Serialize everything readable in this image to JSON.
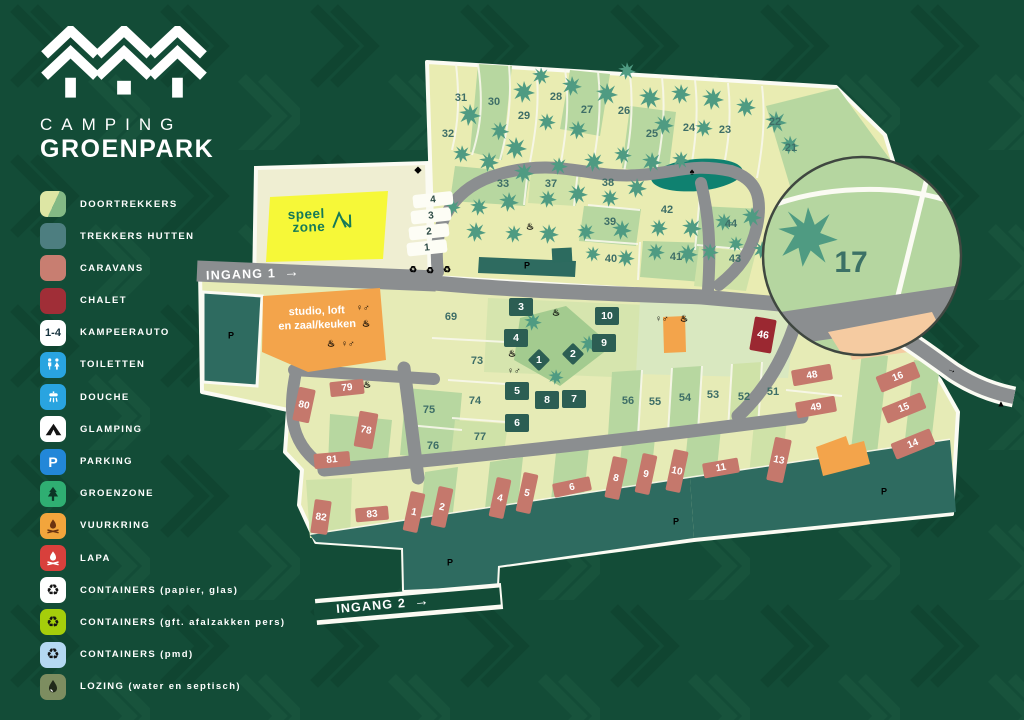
{
  "brand": {
    "name_line1": "CAMPING",
    "name_line2": "GROENPARK"
  },
  "legend": [
    {
      "id": "doortrekkers",
      "label": "DOORTREKKERS"
    },
    {
      "id": "trekkers-hutten",
      "label": "TREKKERS HUTTEN"
    },
    {
      "id": "caravans",
      "label": "CARAVANS"
    },
    {
      "id": "chalet",
      "label": "CHALET"
    },
    {
      "id": "kampeerauto",
      "label": "KAMPEERAUTO",
      "badge": "1-4"
    },
    {
      "id": "toiletten",
      "label": "TOILETTEN"
    },
    {
      "id": "douche",
      "label": "DOUCHE"
    },
    {
      "id": "glamping",
      "label": "GLAMPING"
    },
    {
      "id": "parking",
      "label": "PARKING",
      "badge": "P"
    },
    {
      "id": "groenzone",
      "label": "GROENZONE"
    },
    {
      "id": "vuurkring",
      "label": "VUURKRING"
    },
    {
      "id": "lapa",
      "label": "LAPA"
    },
    {
      "id": "containers-papier",
      "label": "CONTAINERS (papier, glas)",
      "glyph": "♻"
    },
    {
      "id": "containers-gft",
      "label": "CONTAINERS (gft. afalzakken pers)",
      "glyph": "♻"
    },
    {
      "id": "containers-pmd",
      "label": "CONTAINERS (pmd)",
      "glyph": "♻"
    },
    {
      "id": "lozing",
      "label": "LOZING (water en septisch)"
    }
  ],
  "map": {
    "entrances": [
      {
        "label": "INGANG 1",
        "arrow": "→"
      },
      {
        "label": "INGANG 2",
        "arrow": "→"
      }
    ],
    "speelzone": {
      "line1": "speel",
      "line2": "zone"
    },
    "studio": {
      "line1": "studio, loft",
      "line2": "en zaal/keuken"
    },
    "magnifier": {
      "plot": "17"
    },
    "plots": [
      {
        "n": "31",
        "x": 461,
        "y": 98
      },
      {
        "n": "30",
        "x": 494,
        "y": 102
      },
      {
        "n": "32",
        "x": 448,
        "y": 134
      },
      {
        "n": "29",
        "x": 524,
        "y": 116
      },
      {
        "n": "28",
        "x": 556,
        "y": 97
      },
      {
        "n": "27",
        "x": 587,
        "y": 110
      },
      {
        "n": "26",
        "x": 624,
        "y": 111
      },
      {
        "n": "25",
        "x": 652,
        "y": 134
      },
      {
        "n": "24",
        "x": 689,
        "y": 128
      },
      {
        "n": "23",
        "x": 725,
        "y": 130
      },
      {
        "n": "22",
        "x": 775,
        "y": 122
      },
      {
        "n": "21",
        "x": 791,
        "y": 148
      },
      {
        "n": "33",
        "x": 503,
        "y": 184
      },
      {
        "n": "37",
        "x": 551,
        "y": 184
      },
      {
        "n": "38",
        "x": 608,
        "y": 183
      },
      {
        "n": "39",
        "x": 610,
        "y": 222
      },
      {
        "n": "40",
        "x": 611,
        "y": 259
      },
      {
        "n": "41",
        "x": 676,
        "y": 257
      },
      {
        "n": "42",
        "x": 667,
        "y": 210
      },
      {
        "n": "43",
        "x": 735,
        "y": 259
      },
      {
        "n": "44",
        "x": 731,
        "y": 224
      },
      {
        "n": "69",
        "x": 451,
        "y": 317
      },
      {
        "n": "73",
        "x": 477,
        "y": 361
      },
      {
        "n": "74",
        "x": 475,
        "y": 401
      },
      {
        "n": "75",
        "x": 429,
        "y": 410
      },
      {
        "n": "76",
        "x": 433,
        "y": 446
      },
      {
        "n": "77",
        "x": 480,
        "y": 437
      },
      {
        "n": "51",
        "x": 773,
        "y": 392
      },
      {
        "n": "52",
        "x": 744,
        "y": 397
      },
      {
        "n": "53",
        "x": 713,
        "y": 395
      },
      {
        "n": "54",
        "x": 685,
        "y": 398
      },
      {
        "n": "55",
        "x": 655,
        "y": 402
      },
      {
        "n": "56",
        "x": 628,
        "y": 401
      }
    ],
    "huts": [
      {
        "n": "3",
        "x": 521,
        "y": 307
      },
      {
        "n": "10",
        "x": 607,
        "y": 316
      },
      {
        "n": "4",
        "x": 516,
        "y": 338
      },
      {
        "n": "9",
        "x": 604,
        "y": 343
      },
      {
        "n": "1",
        "x": 539,
        "y": 360,
        "w": 16,
        "h": 16,
        "r": 45,
        "cls": "diamond"
      },
      {
        "n": "2",
        "x": 573,
        "y": 354,
        "w": 16,
        "h": 16,
        "r": 45,
        "cls": "diamond"
      },
      {
        "n": "5",
        "x": 517,
        "y": 391
      },
      {
        "n": "8",
        "x": 547,
        "y": 400
      },
      {
        "n": "7",
        "x": 574,
        "y": 399
      },
      {
        "n": "6",
        "x": 517,
        "y": 423
      }
    ],
    "caravans": [
      {
        "n": "79",
        "x": 347,
        "y": 388,
        "w": 34,
        "h": 15,
        "r": -6
      },
      {
        "n": "80",
        "x": 304,
        "y": 405,
        "w": 17,
        "h": 34,
        "r": 12
      },
      {
        "n": "78",
        "x": 366,
        "y": 430,
        "w": 19,
        "h": 36,
        "r": 10
      },
      {
        "n": "81",
        "x": 332,
        "y": 460,
        "w": 36,
        "h": 15,
        "r": -5
      },
      {
        "n": "82",
        "x": 321,
        "y": 517,
        "w": 17,
        "h": 34,
        "r": 8
      },
      {
        "n": "83",
        "x": 372,
        "y": 514,
        "w": 33,
        "h": 14,
        "r": -5
      },
      {
        "n": "1",
        "x": 414,
        "y": 512,
        "w": 15,
        "h": 40,
        "r": 12
      },
      {
        "n": "2",
        "x": 442,
        "y": 507,
        "w": 15,
        "h": 40,
        "r": 12
      },
      {
        "n": "4",
        "x": 500,
        "y": 498,
        "w": 15,
        "h": 40,
        "r": 12
      },
      {
        "n": "5",
        "x": 527,
        "y": 493,
        "w": 15,
        "h": 40,
        "r": 12
      },
      {
        "n": "6",
        "x": 572,
        "y": 487,
        "w": 38,
        "h": 14,
        "r": -12
      },
      {
        "n": "8",
        "x": 616,
        "y": 478,
        "w": 15,
        "h": 42,
        "r": 12
      },
      {
        "n": "9",
        "x": 646,
        "y": 474,
        "w": 15,
        "h": 40,
        "r": 12
      },
      {
        "n": "10",
        "x": 677,
        "y": 471,
        "w": 15,
        "h": 42,
        "r": 12
      },
      {
        "n": "11",
        "x": 721,
        "y": 468,
        "w": 36,
        "h": 15,
        "r": -10
      },
      {
        "n": "13",
        "x": 779,
        "y": 460,
        "w": 17,
        "h": 44,
        "r": 12
      },
      {
        "n": "16",
        "x": 898,
        "y": 377,
        "w": 42,
        "h": 17,
        "r": -22
      },
      {
        "n": "15",
        "x": 904,
        "y": 408,
        "w": 42,
        "h": 17,
        "r": -22
      },
      {
        "n": "14",
        "x": 913,
        "y": 444,
        "w": 42,
        "h": 17,
        "r": -22
      },
      {
        "n": "48",
        "x": 812,
        "y": 375,
        "w": 40,
        "h": 16,
        "r": -10
      },
      {
        "n": "49",
        "x": 816,
        "y": 407,
        "w": 40,
        "h": 16,
        "r": -10
      }
    ],
    "chalets": [
      {
        "n": "46",
        "x": 763,
        "y": 335,
        "w": 22,
        "h": 34,
        "r": 10
      }
    ],
    "camper_spots": [
      {
        "n": "4",
        "x": 433,
        "y": 200,
        "w": 40,
        "h": 13,
        "r": -6
      },
      {
        "n": "3",
        "x": 431,
        "y": 216,
        "w": 40,
        "h": 13,
        "r": -6
      },
      {
        "n": "2",
        "x": 429,
        "y": 232,
        "w": 40,
        "h": 13,
        "r": -6
      },
      {
        "n": "1",
        "x": 427,
        "y": 248,
        "w": 40,
        "h": 13,
        "r": -6
      }
    ],
    "icons": [
      {
        "t": "parking",
        "name": "parking-icon",
        "g": "P",
        "x": 231,
        "y": 336
      },
      {
        "t": "parking",
        "name": "parking-icon",
        "g": "P",
        "x": 527,
        "y": 266
      },
      {
        "t": "parking",
        "name": "parking-icon",
        "g": "P",
        "x": 450,
        "y": 563
      },
      {
        "t": "parking",
        "name": "parking-icon",
        "g": "P",
        "x": 676,
        "y": 522
      },
      {
        "t": "parking",
        "name": "parking-icon",
        "g": "P",
        "x": 884,
        "y": 492
      },
      {
        "t": "toilet",
        "name": "toilets-icon",
        "g": "♀♂",
        "x": 363,
        "y": 308
      },
      {
        "t": "toilet",
        "name": "toilets-icon",
        "g": "♀♂",
        "x": 348,
        "y": 344
      },
      {
        "t": "toilet",
        "name": "toilets-icon",
        "g": "♀♂",
        "x": 514,
        "y": 371
      },
      {
        "t": "toilet",
        "name": "toilets-icon",
        "g": "♀♂",
        "x": 662,
        "y": 319
      },
      {
        "t": "shower",
        "name": "shower-icon",
        "g": "♨",
        "x": 366,
        "y": 324
      },
      {
        "t": "shower",
        "name": "shower-icon",
        "g": "♨",
        "x": 331,
        "y": 344
      },
      {
        "t": "shower",
        "name": "shower-icon",
        "g": "♨",
        "x": 512,
        "y": 354
      },
      {
        "t": "shower",
        "name": "shower-icon",
        "g": "♨",
        "x": 684,
        "y": 319
      },
      {
        "t": "shower",
        "name": "shower-icon",
        "g": "♨",
        "x": 367,
        "y": 385
      },
      {
        "t": "recpmd",
        "name": "recycle-pmd-icon",
        "g": "♻",
        "x": 413,
        "y": 270
      },
      {
        "t": "recpap",
        "name": "recycle-paper-icon",
        "g": "♻",
        "x": 430,
        "y": 271
      },
      {
        "t": "recgft",
        "name": "recycle-gft-icon",
        "g": "♻",
        "x": 447,
        "y": 270
      },
      {
        "t": "vuur",
        "name": "campfire-icon",
        "g": "♨",
        "x": 530,
        "y": 227
      },
      {
        "t": "lapa",
        "name": "lapa-icon",
        "g": "♨",
        "x": 556,
        "y": 313
      },
      {
        "t": "groenbox",
        "name": "tree-icon",
        "g": "♠",
        "x": 692,
        "y": 172
      },
      {
        "t": "glamping",
        "name": "glamping-icon",
        "g": "▲",
        "x": 1001,
        "y": 404
      },
      {
        "t": "lozing",
        "name": "drain-icon",
        "g": "◆",
        "x": 418,
        "y": 170
      },
      {
        "t": "arrow",
        "name": "exit-arrow-icon",
        "g": "→",
        "x": 952,
        "y": 370,
        "r": 20
      }
    ]
  },
  "palette": {
    "background": "#134c37",
    "plot_yellow": "#e9ecb2",
    "plot_green": "#b7d7a0",
    "road_gray": "#8b8e90",
    "water_teal": "#0f8170",
    "parking_teal": "#2e6b60",
    "caravan_salmon": "#c5786c",
    "chalet_red": "#9b2831",
    "hut_teal": "#2c5e53",
    "building_orange": "#f3a44b",
    "speelzone_yellow": "#f6f838",
    "accent_blue": "#2287d8"
  }
}
